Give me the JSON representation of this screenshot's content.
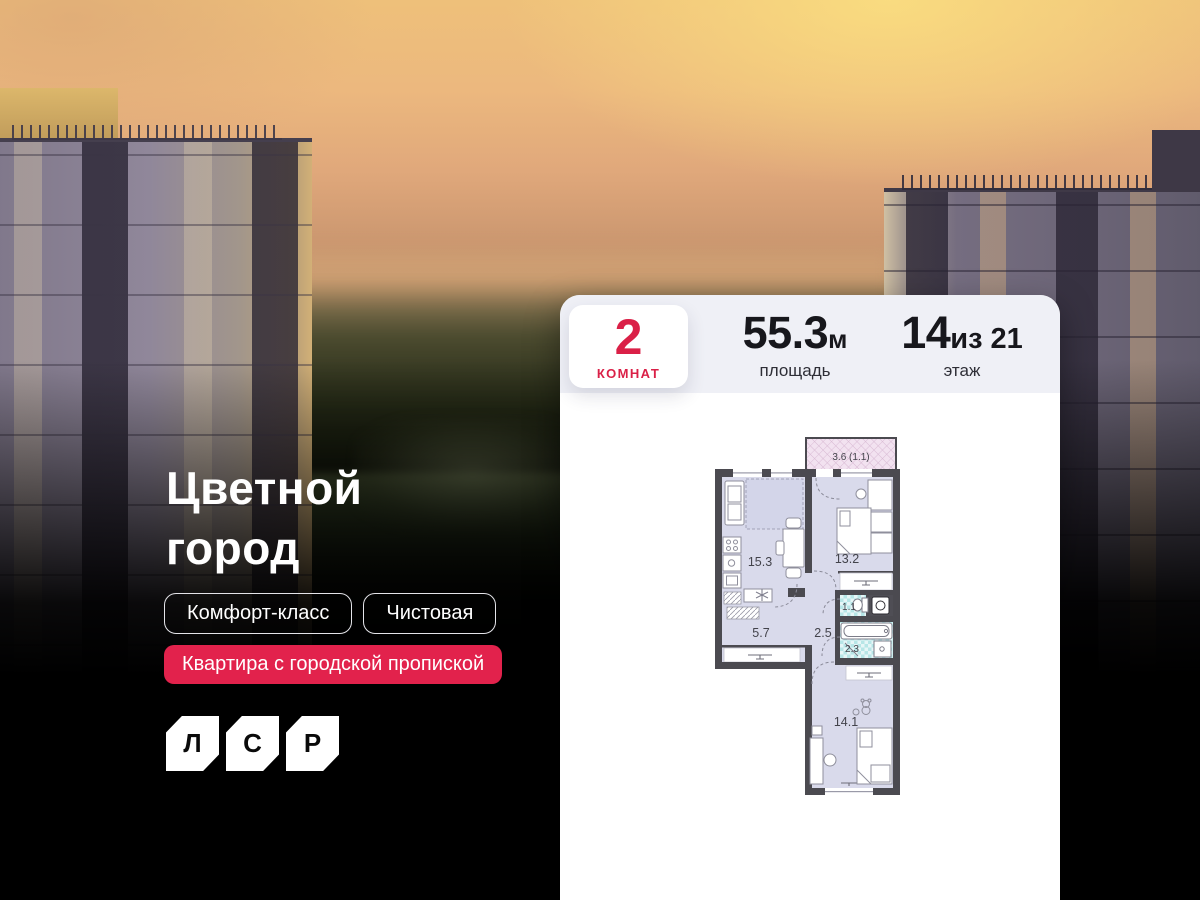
{
  "project": {
    "title_line1": "Цветной",
    "title_line2": "город",
    "tags": {
      "class": "Комфорт-класс",
      "finish": "Чистовая",
      "registration": "Квартира с городской пропиской"
    },
    "logo_letters": [
      "Л",
      "С",
      "Р"
    ]
  },
  "card": {
    "rooms": {
      "value": "2",
      "label": "КОМНАТ"
    },
    "area": {
      "value": "55.3",
      "unit": "м",
      "label": "площадь"
    },
    "floor": {
      "value": "14",
      "of": "из 21",
      "label": "этаж"
    },
    "plan": {
      "balcony": "3.6 (1.1)",
      "living": "15.3",
      "bedroom": "13.2",
      "hall": "5.7",
      "corridor": "2.5",
      "wc": "1.1",
      "bath": "2.3",
      "bedroom2": "14.1"
    }
  },
  "colors": {
    "accent_red": "#e2224c",
    "chip_red_text": "#da2047",
    "card_header_bg": "#eff0f6",
    "plan_wall": "#4b4a50",
    "plan_room_fill": "#d9daeb",
    "plan_wet_fill": "#b7e6e7",
    "plan_balcony_fill": "#f2e2f0"
  }
}
